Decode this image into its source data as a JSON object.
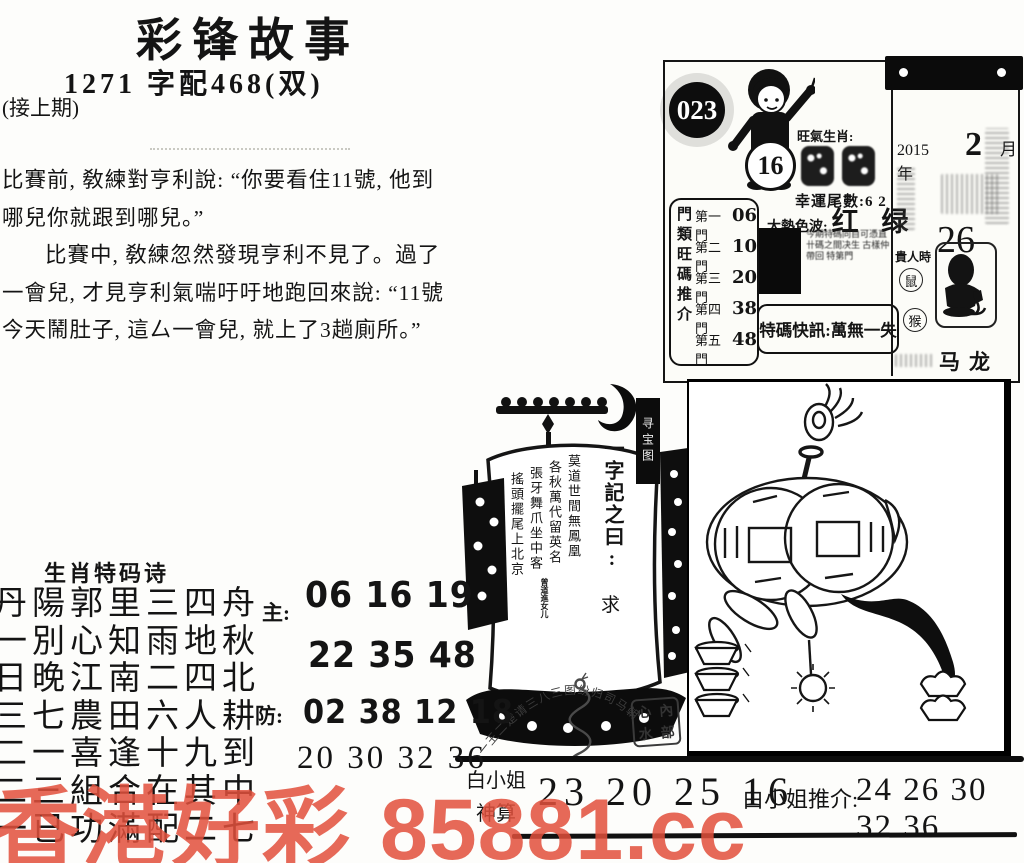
{
  "header": {
    "title": "彩锋故事",
    "subtitle": "1271 字配468(双)",
    "note": "(接上期)"
  },
  "story": {
    "para1": "比賽前, 敎練對亨利說: “你要看住11號, 他到哪兒你就跟到哪兒。”",
    "para2": "比賽中, 敎練忽然發現亨利不見了。過了一會兒, 才見亨利氣喘吁吁地跑回來說: “11號今天鬧肚子, 這厶一會兒, 就上了3趟廁所。”"
  },
  "info_card": {
    "issue": "023",
    "ball": "16",
    "zodiac_label": "旺氣生肖:",
    "lucky_tail": "幸運尾數:6 2",
    "hot_color_label": "大熱色波:",
    "hot_color_value": "红 绿",
    "tip_text": "今期特碼同自可憑直 卄碼之間决生 古樣仲帶回 特第門",
    "special_note": "特碼快訊:萬無一失",
    "gates_title": "門類旺碼推介",
    "gates": [
      {
        "label": "第一門",
        "num": "06"
      },
      {
        "label": "第二門",
        "num": "10"
      },
      {
        "label": "第三門",
        "num": "20"
      },
      {
        "label": "第四門",
        "num": "38"
      },
      {
        "label": "第五門",
        "num": "48"
      }
    ]
  },
  "calendar": {
    "year": "2015年",
    "month": "2",
    "month_unit": "月",
    "day": "26",
    "noble_label": "貴人時",
    "noble_1": "鼠",
    "noble_2": "猴",
    "bottom_value": "马龙"
  },
  "ship": {
    "tag": "寻宝图",
    "motto": "一字記之曰:",
    "motto_word": "求",
    "poem": [
      "莫道世間無鳳凰",
      "各秋萬代留英名",
      "張牙舞爪坐中客",
      "搖頭擺尾上北京"
    ],
    "signature": "曾道進女儿"
  },
  "seal": {
    "arc_text": "一王二楚请三八三图纷归司马朝",
    "stamp": [
      "心",
      "內",
      "水",
      "部"
    ]
  },
  "zodiac_poem": {
    "title": "生肖特码诗",
    "lines": [
      "丹陽郭里三四舟",
      "一別心知雨地秋",
      "日晚江南二四北",
      "三七農田六人耕",
      "二一喜逢十九到",
      "二三組合在其中",
      "一已功滿配二七"
    ],
    "main_label": "主:",
    "main_row1": "06 16 19",
    "main_row2": "22 35 48",
    "guard_label": "防:",
    "guard_row1": "02 38 12 18",
    "guard_row2": "20 30 32 36"
  },
  "bottom": {
    "name_top": "白小姐",
    "name_bottom": "神算",
    "numbers": "23 20 25 16",
    "recommend_label": "白小姐推介:",
    "recommend_numbers": "24 26 30 32 36"
  },
  "watermark": {
    "left": "香港好彩",
    "right": "85881.cc",
    "color": "#e2503c"
  }
}
